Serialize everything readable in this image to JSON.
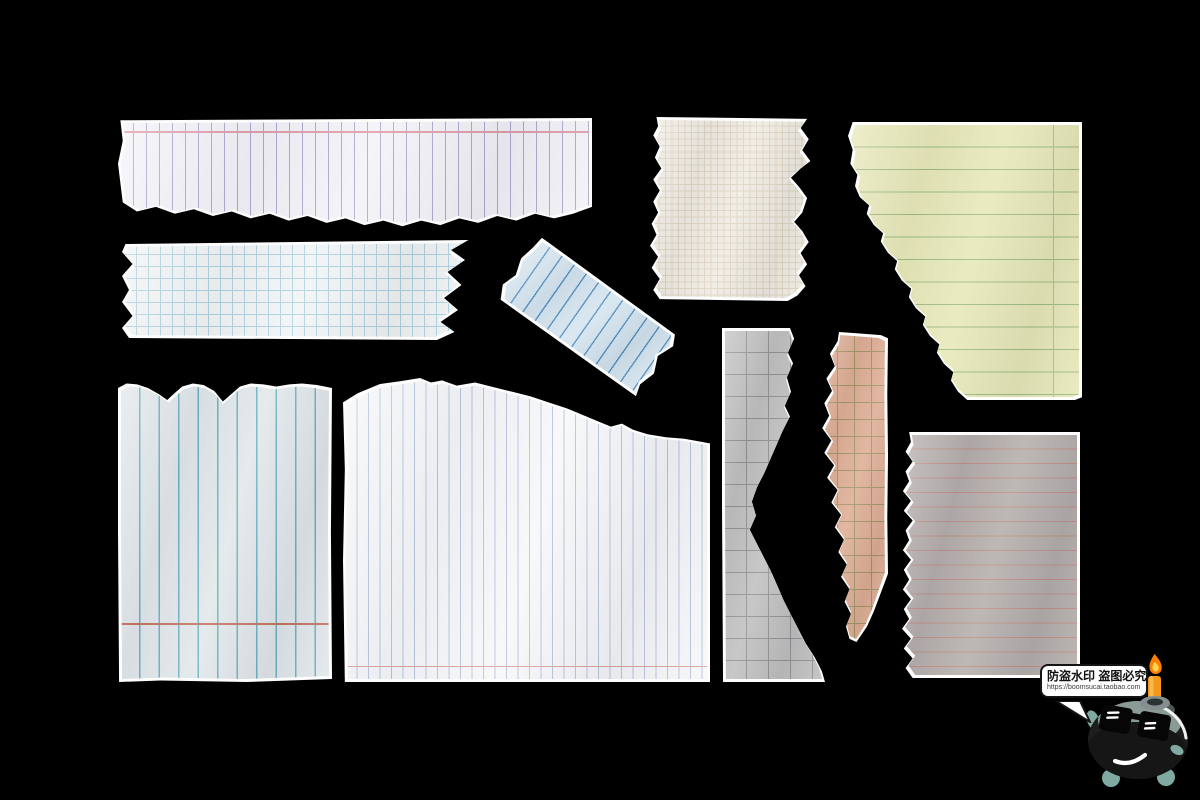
{
  "scene": {
    "background": "#000000",
    "width": 1200,
    "height": 800,
    "description": "ten torn notebook paper scraps on black background"
  },
  "watermark": {
    "bubble_text": "防盗水印 盗图必究",
    "bubble_url": "https://boomsucai.taobao.com",
    "character": "bomb-mascot-with-sunglasses-and-lit-candle-fuse",
    "bubble_bg": "#ffffff",
    "bubble_border": "#141414",
    "flame_outer": "#fd7f03",
    "flame_inner": "#ffd44f",
    "candle": "#f2991c",
    "fin_color": "#7fa9a1",
    "body_color": "#1d1e1d",
    "face_plate": "#8a9a94"
  },
  "edge_color": "#fdfdfd",
  "pieces": [
    {
      "id": "paper-white-vertical-ruled-strip",
      "label": "white strip with vertical purple rules and pink top margin, torn bottom",
      "x": 118,
      "y": 118,
      "w": 474,
      "h": 114,
      "rot": 0,
      "paper": "#f3f2f7",
      "pattern": {
        "type": "vlines",
        "spacing": 13,
        "color": "#a9a6cc",
        "weight": 1
      },
      "accents": [
        {
          "type": "hline",
          "pos": 9,
          "color": "#e09aa8",
          "weight": 2,
          "name": "pink-margin-line"
        }
      ],
      "outline": [
        [
          0.5,
          2
        ],
        [
          100,
          0
        ],
        [
          100,
          78
        ],
        [
          96,
          84
        ],
        [
          92,
          88
        ],
        [
          88,
          84
        ],
        [
          84,
          90
        ],
        [
          80,
          86
        ],
        [
          76,
          92
        ],
        [
          72,
          88
        ],
        [
          68,
          94
        ],
        [
          64,
          90
        ],
        [
          60,
          95
        ],
        [
          56,
          90
        ],
        [
          52,
          94
        ],
        [
          48,
          88
        ],
        [
          44,
          92
        ],
        [
          40,
          86
        ],
        [
          36,
          90
        ],
        [
          32,
          84
        ],
        [
          28,
          88
        ],
        [
          24,
          82
        ],
        [
          20,
          86
        ],
        [
          16,
          80
        ],
        [
          12,
          84
        ],
        [
          8,
          78
        ],
        [
          4,
          82
        ],
        [
          1,
          74
        ],
        [
          0,
          40
        ],
        [
          1,
          20
        ]
      ]
    },
    {
      "id": "paper-blue-grid-strip",
      "label": "white strip with light blue graph grid, torn ends",
      "x": 122,
      "y": 240,
      "w": 350,
      "h": 100,
      "rot": 0,
      "paper": "#f1f4f4",
      "pattern": {
        "type": "grid",
        "spacing": 12,
        "color": "#aed0de",
        "weight": 1
      },
      "accents": [],
      "outline": [
        [
          1,
          4
        ],
        [
          99,
          0
        ],
        [
          94,
          10
        ],
        [
          98,
          20
        ],
        [
          93,
          32
        ],
        [
          97,
          45
        ],
        [
          92,
          58
        ],
        [
          96,
          70
        ],
        [
          91,
          82
        ],
        [
          95,
          92
        ],
        [
          90,
          100
        ],
        [
          2,
          98
        ],
        [
          0,
          88
        ],
        [
          3,
          76
        ],
        [
          0,
          62
        ],
        [
          2,
          50
        ],
        [
          0,
          36
        ],
        [
          3,
          24
        ],
        [
          0,
          12
        ]
      ]
    },
    {
      "id": "paper-blue-ruled-tilted-strip",
      "label": "light blue tilted strip with dark blue rules",
      "x": 500,
      "y": 278,
      "w": 175,
      "h": 76,
      "rot": 35,
      "paper": "#d2e3ee",
      "pattern": {
        "type": "vlines",
        "spacing": 15,
        "color": "#4d8cbd",
        "weight": 1.4
      },
      "accents": [],
      "outline": [
        [
          3,
          0
        ],
        [
          97,
          4
        ],
        [
          100,
          18
        ],
        [
          96,
          40
        ],
        [
          100,
          62
        ],
        [
          97,
          84
        ],
        [
          99,
          100
        ],
        [
          4,
          98
        ],
        [
          0,
          80
        ],
        [
          3,
          60
        ],
        [
          0,
          38
        ],
        [
          2,
          18
        ]
      ]
    },
    {
      "id": "paper-cream-graph-piece",
      "label": "cream fine graph paper, torn left and right edges",
      "x": 650,
      "y": 117,
      "w": 162,
      "h": 184,
      "rot": 0,
      "paper": "#efebe1",
      "pattern": {
        "type": "grid",
        "spacing": 6.5,
        "color": "#ddd3c2",
        "weight": 1
      },
      "pattern2": {
        "type": "grid",
        "spacing": 32.5,
        "color": "#c6b69e",
        "weight": 1
      },
      "accents": [],
      "outline": [
        [
          4,
          0
        ],
        [
          97,
          1
        ],
        [
          93,
          6
        ],
        [
          98,
          12
        ],
        [
          94,
          18
        ],
        [
          99,
          24
        ],
        [
          93,
          28
        ],
        [
          87,
          33
        ],
        [
          92,
          38
        ],
        [
          97,
          44
        ],
        [
          94,
          52
        ],
        [
          89,
          57
        ],
        [
          94,
          62
        ],
        [
          98,
          68
        ],
        [
          93,
          74
        ],
        [
          97,
          80
        ],
        [
          92,
          86
        ],
        [
          96,
          92
        ],
        [
          91,
          97
        ],
        [
          85,
          100
        ],
        [
          6,
          99
        ],
        [
          2,
          94
        ],
        [
          6,
          88
        ],
        [
          1,
          82
        ],
        [
          5,
          76
        ],
        [
          0,
          70
        ],
        [
          4,
          64
        ],
        [
          1,
          58
        ],
        [
          5,
          52
        ],
        [
          2,
          46
        ],
        [
          6,
          40
        ],
        [
          2,
          34
        ],
        [
          7,
          28
        ],
        [
          3,
          22
        ],
        [
          6,
          16
        ],
        [
          2,
          10
        ],
        [
          5,
          5
        ]
      ]
    },
    {
      "id": "paper-yellow-legal-pad-piece",
      "label": "yellow legal pad with green rules, diagonal torn left edge",
      "x": 848,
      "y": 122,
      "w": 234,
      "h": 278,
      "rot": 0,
      "paper": "#e6e7b5",
      "pattern": {
        "type": "hlines",
        "spacing": 22.5,
        "color": "#9cb87d",
        "weight": 1.2
      },
      "accents": [
        {
          "type": "vline",
          "pos": 88.5,
          "color": "#aec08f",
          "weight": 1.5,
          "name": "margin-line"
        }
      ],
      "outline": [
        [
          2,
          0
        ],
        [
          100,
          0
        ],
        [
          100,
          99
        ],
        [
          97,
          100
        ],
        [
          51,
          100
        ],
        [
          47,
          97
        ],
        [
          44,
          93
        ],
        [
          45,
          90
        ],
        [
          41,
          87
        ],
        [
          38,
          83
        ],
        [
          39,
          80
        ],
        [
          35,
          77
        ],
        [
          32,
          73
        ],
        [
          33,
          70
        ],
        [
          29,
          67
        ],
        [
          26,
          63
        ],
        [
          27,
          60
        ],
        [
          23,
          57
        ],
        [
          20,
          53
        ],
        [
          21,
          50
        ],
        [
          17,
          47
        ],
        [
          14,
          43
        ],
        [
          15,
          40
        ],
        [
          11,
          37
        ],
        [
          8,
          33
        ],
        [
          9,
          30
        ],
        [
          5,
          27
        ],
        [
          3,
          23
        ],
        [
          4,
          19
        ],
        [
          1,
          15
        ],
        [
          2,
          10
        ],
        [
          0,
          5
        ]
      ]
    },
    {
      "id": "paper-grey-blue-vertical-ruled-piece",
      "label": "pale blue-grey sheet with teal vertical rules, scalloped torn top, red line near bottom",
      "x": 118,
      "y": 382,
      "w": 214,
      "h": 300,
      "rot": 0,
      "paper": "#e0e6e9",
      "pattern": {
        "type": "vlines",
        "spacing": 19.5,
        "color": "#67aec1",
        "weight": 1.4
      },
      "accents": [
        {
          "type": "hline",
          "pos": 81,
          "color": "#c4705c",
          "weight": 2,
          "name": "red-rule-line"
        }
      ],
      "outline": [
        [
          0,
          2
        ],
        [
          4,
          0.5
        ],
        [
          9,
          0.8
        ],
        [
          14,
          2
        ],
        [
          19,
          4
        ],
        [
          23,
          6
        ],
        [
          26,
          4
        ],
        [
          30,
          1.5
        ],
        [
          35,
          0.5
        ],
        [
          40,
          1
        ],
        [
          45,
          3
        ],
        [
          49,
          6.5
        ],
        [
          53,
          4
        ],
        [
          57,
          1.5
        ],
        [
          62,
          0.5
        ],
        [
          68,
          0.8
        ],
        [
          74,
          1.5
        ],
        [
          80,
          0.8
        ],
        [
          86,
          0.5
        ],
        [
          93,
          1
        ],
        [
          100,
          2
        ],
        [
          99.5,
          50
        ],
        [
          100,
          99
        ],
        [
          60,
          100
        ],
        [
          20,
          99.5
        ],
        [
          0.5,
          100
        ],
        [
          0,
          50
        ]
      ]
    },
    {
      "id": "paper-white-fine-ruled-large-piece",
      "label": "large white sheet with fine vertical blue rules, torn sloping top, pink line near bottom",
      "x": 343,
      "y": 378,
      "w": 367,
      "h": 304,
      "rot": 0,
      "paper": "#f5f7f9",
      "pattern": {
        "type": "vlines",
        "spacing": 11.5,
        "color": "#b7c3da",
        "weight": 1
      },
      "accents": [
        {
          "type": "hline",
          "pos": 95.5,
          "color": "#dba0a0",
          "weight": 1.5,
          "name": "pink-rule-line"
        }
      ],
      "outline": [
        [
          0,
          8
        ],
        [
          4,
          5
        ],
        [
          10,
          2
        ],
        [
          16,
          1
        ],
        [
          21,
          0
        ],
        [
          24,
          1.5
        ],
        [
          27,
          0.8
        ],
        [
          31,
          2.5
        ],
        [
          36,
          1.5
        ],
        [
          41,
          3
        ],
        [
          46,
          4.5
        ],
        [
          51,
          6
        ],
        [
          56,
          8
        ],
        [
          61,
          10
        ],
        [
          66,
          12.5
        ],
        [
          70,
          14.5
        ],
        [
          73,
          16
        ],
        [
          76,
          15
        ],
        [
          79,
          17
        ],
        [
          83,
          18.5
        ],
        [
          88,
          19.5
        ],
        [
          93,
          20
        ],
        [
          100,
          21.5
        ],
        [
          100,
          100
        ],
        [
          0.5,
          100
        ],
        [
          0,
          60
        ],
        [
          0.5,
          30
        ]
      ]
    },
    {
      "id": "paper-grey-grid-strip",
      "label": "grey graph paper strip, torn bulging right edge",
      "x": 722,
      "y": 328,
      "w": 103,
      "h": 354,
      "rot": 0,
      "paper": "#bdbdbd",
      "pattern": {
        "type": "grid",
        "spacing": 22,
        "color": "#8d8d8d",
        "weight": 1
      },
      "accents": [],
      "outline": [
        [
          0,
          0
        ],
        [
          66,
          0
        ],
        [
          70,
          3
        ],
        [
          64,
          7
        ],
        [
          69,
          10
        ],
        [
          63,
          14
        ],
        [
          67,
          18
        ],
        [
          61,
          22
        ],
        [
          66,
          25
        ],
        [
          59,
          29
        ],
        [
          53,
          33
        ],
        [
          47,
          37
        ],
        [
          41,
          41
        ],
        [
          34,
          45
        ],
        [
          29,
          49
        ],
        [
          33,
          53
        ],
        [
          27,
          57
        ],
        [
          34,
          61
        ],
        [
          41,
          65
        ],
        [
          48,
          69
        ],
        [
          54,
          73
        ],
        [
          60,
          77
        ],
        [
          67,
          81
        ],
        [
          74,
          85
        ],
        [
          81,
          89
        ],
        [
          90,
          93
        ],
        [
          97,
          97
        ],
        [
          100,
          100
        ],
        [
          1,
          100
        ],
        [
          0,
          50
        ]
      ]
    },
    {
      "id": "paper-salmon-grid-strip",
      "label": "salmon strip with olive grid, very wavy torn left edge",
      "x": 818,
      "y": 332,
      "w": 70,
      "h": 310,
      "rot": 0,
      "paper": "#dcaa90",
      "pattern": {
        "type": "grid",
        "spacing": 17,
        "color": "#9f8f60",
        "weight": 1
      },
      "accents": [],
      "outline": [
        [
          30,
          0
        ],
        [
          60,
          0.5
        ],
        [
          90,
          1
        ],
        [
          100,
          2
        ],
        [
          99,
          20
        ],
        [
          100,
          40
        ],
        [
          99,
          60
        ],
        [
          100,
          78
        ],
        [
          90,
          84
        ],
        [
          80,
          90
        ],
        [
          70,
          95
        ],
        [
          55,
          100
        ],
        [
          45,
          99
        ],
        [
          40,
          95
        ],
        [
          47,
          91
        ],
        [
          38,
          87
        ],
        [
          45,
          83
        ],
        [
          33,
          79
        ],
        [
          41,
          75
        ],
        [
          29,
          71
        ],
        [
          37,
          67
        ],
        [
          24,
          63
        ],
        [
          33,
          59
        ],
        [
          19,
          55
        ],
        [
          28,
          51
        ],
        [
          13,
          47
        ],
        [
          23,
          43
        ],
        [
          9,
          39
        ],
        [
          19,
          35
        ],
        [
          6,
          31
        ],
        [
          16,
          27
        ],
        [
          9,
          23
        ],
        [
          20,
          19
        ],
        [
          12,
          15
        ],
        [
          24,
          11
        ],
        [
          17,
          7
        ],
        [
          28,
          3
        ]
      ]
    },
    {
      "id": "paper-taupe-ruled-piece",
      "label": "taupe sheet with horizontal pink rules, torn left edge",
      "x": 902,
      "y": 432,
      "w": 178,
      "h": 246,
      "rot": 0,
      "paper": "#b1aaa8",
      "pattern": {
        "type": "hlines",
        "spacing": 14.5,
        "color": "#bd8b80",
        "weight": 1.2
      },
      "accents": [],
      "outline": [
        [
          4,
          0
        ],
        [
          100,
          0
        ],
        [
          100,
          100
        ],
        [
          6,
          100
        ],
        [
          2,
          96
        ],
        [
          6,
          92
        ],
        [
          1,
          88
        ],
        [
          5,
          84
        ],
        [
          0,
          80
        ],
        [
          4,
          76
        ],
        [
          1,
          72
        ],
        [
          5,
          68
        ],
        [
          0.5,
          64
        ],
        [
          4,
          60
        ],
        [
          1,
          56
        ],
        [
          5,
          52
        ],
        [
          0.5,
          48
        ],
        [
          4,
          44
        ],
        [
          2,
          40
        ],
        [
          6,
          36
        ],
        [
          1,
          32
        ],
        [
          5,
          28
        ],
        [
          0.5,
          24
        ],
        [
          4,
          20
        ],
        [
          2,
          16
        ],
        [
          6,
          12
        ],
        [
          2,
          8
        ],
        [
          5,
          4
        ]
      ]
    }
  ]
}
